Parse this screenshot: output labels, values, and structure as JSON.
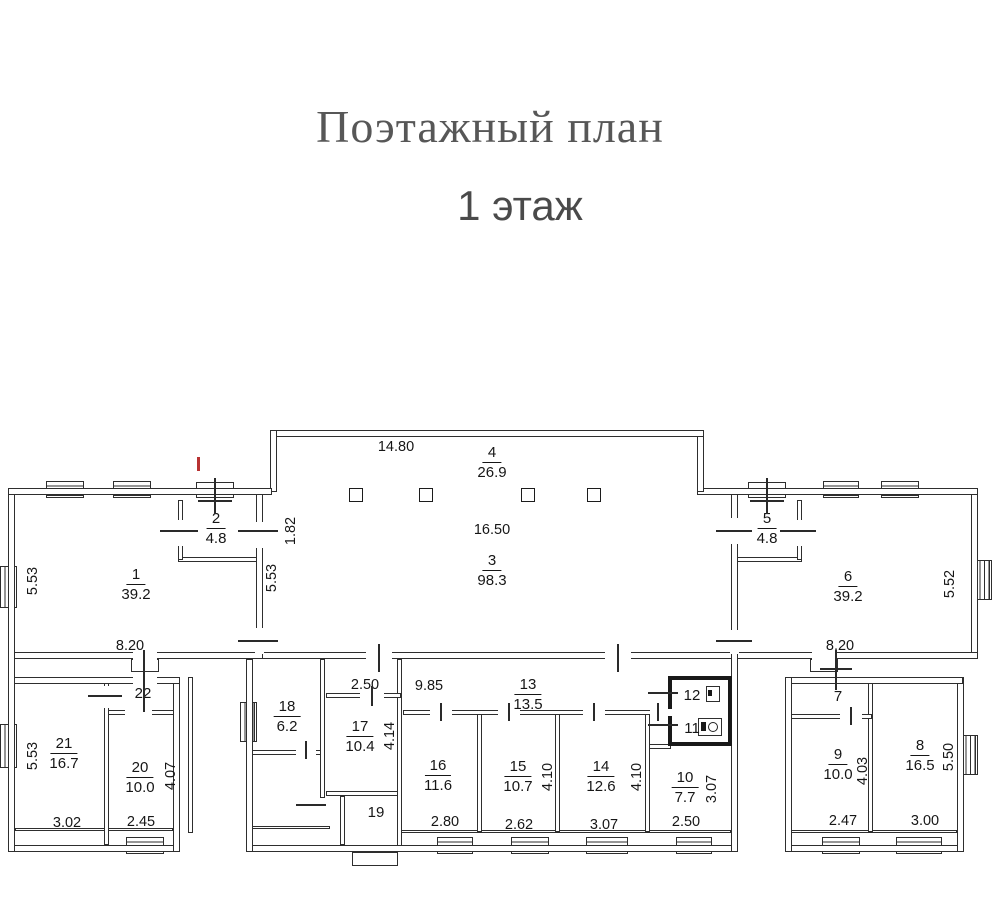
{
  "title": {
    "line1": "Поэтажный план",
    "line2": "1 этаж"
  },
  "colors": {
    "line": "#2e2e2e",
    "text": "#161616",
    "title_serif": "#575757",
    "title_sans": "#4a4a4a",
    "red_mark": "#b83232"
  },
  "rooms": {
    "r1": {
      "num": "1",
      "area": "39.2"
    },
    "r2": {
      "num": "2",
      "area": "4.8"
    },
    "r3": {
      "num": "3",
      "area": "98.3"
    },
    "r4": {
      "num": "4",
      "area": "26.9"
    },
    "r5": {
      "num": "5",
      "area": "4.8"
    },
    "r6": {
      "num": "6",
      "area": "39.2"
    },
    "r7": {
      "num": "7"
    },
    "r8": {
      "num": "8",
      "area": "16.5"
    },
    "r9": {
      "num": "9",
      "area": "10.0"
    },
    "r10": {
      "num": "10",
      "area": "7.7"
    },
    "r11": {
      "num": "11"
    },
    "r12": {
      "num": "12"
    },
    "r13": {
      "num": "13",
      "area": "13.5"
    },
    "r14": {
      "num": "14",
      "area": "12.6"
    },
    "r15": {
      "num": "15",
      "area": "10.7"
    },
    "r16": {
      "num": "16",
      "area": "11.6"
    },
    "r17": {
      "num": "17",
      "area": "10.4"
    },
    "r18": {
      "num": "18",
      "area": "6.2"
    },
    "r19": {
      "num": "19"
    },
    "r20": {
      "num": "20",
      "area": "10.0"
    },
    "r21": {
      "num": "21",
      "area": "16.7"
    },
    "r22": {
      "num": "22"
    }
  },
  "dims": {
    "d_14_80": "14.80",
    "d_16_50": "16.50",
    "d_1_82": "1.82",
    "d_5_53_hall": "5.53",
    "d_5_53_room1": "5.53",
    "d_8_20_left": "8.20",
    "d_8_20_right": "8.20",
    "d_5_52": "5.52",
    "d_2_50_corridor": "2.50",
    "d_9_85": "9.85",
    "d_4_14": "4.14",
    "d_5_53_room21": "5.53",
    "d_4_07": "4.07",
    "d_3_02": "3.02",
    "d_2_45": "2.45",
    "d_2_80": "2.80",
    "d_2_62": "2.62",
    "d_3_07_room14": "3.07",
    "d_2_50_room10": "2.50",
    "d_3_07_room10": "3.07",
    "d_4_10_room15": "4.10",
    "d_4_10_room14": "4.10",
    "d_4_03": "4.03",
    "d_2_47": "2.47",
    "d_3_00": "3.00",
    "d_5_50": "5.50"
  }
}
